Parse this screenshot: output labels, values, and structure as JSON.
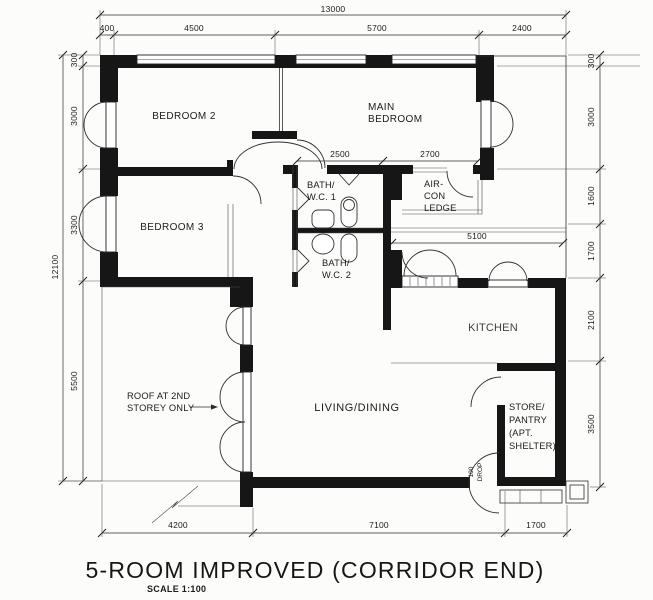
{
  "title": "5-ROOM IMPROVED (CORRIDOR END)",
  "scale_note": "SCALE 1:100",
  "rooms": {
    "bedroom2": "BEDROOM 2",
    "bedroom3": "BEDROOM 3",
    "main_bedroom": {
      "l1": "MAIN",
      "l2": "BEDROOM"
    },
    "bath1": {
      "l1": "BATH/",
      "l2": "W.C. 1"
    },
    "bath2": {
      "l1": "BATH/",
      "l2": "W.C. 2"
    },
    "aircon_ledge": {
      "l1": "AIR-",
      "l2": "CON",
      "l3": "LEDGE"
    },
    "kitchen": "KITCHEN",
    "living_dining": "LIVING/DINING",
    "store": {
      "l1": "STORE/",
      "l2": "PANTRY",
      "l3": "(APT.",
      "l4": "SHELTER)"
    }
  },
  "annotations": {
    "roof_note": {
      "l1": "ROOF AT 2ND",
      "l2": "STOREY ONLY"
    },
    "entrance_drop": {
      "l1": "100",
      "l2": "DROP"
    }
  },
  "dims": {
    "top_total": "13000",
    "top_a": "400",
    "top_b": "4500",
    "top_c": "5700",
    "top_d": "2400",
    "left_total": "12100",
    "left_a": "300",
    "left_b": "3000",
    "left_c": "3300",
    "left_d": "5500",
    "right_a": "300",
    "right_b": "3000",
    "right_c": "1600",
    "right_d": "1700",
    "right_e": "2100",
    "right_f": "3500",
    "mid_a": "2500",
    "mid_b": "2700",
    "mid_c": "5100",
    "bottom_a": "4200",
    "bottom_b": "7100",
    "bottom_c": "1700"
  },
  "colors": {
    "wall": "#161616",
    "line": "#2b2b2b",
    "background": "#fcfcfa"
  }
}
